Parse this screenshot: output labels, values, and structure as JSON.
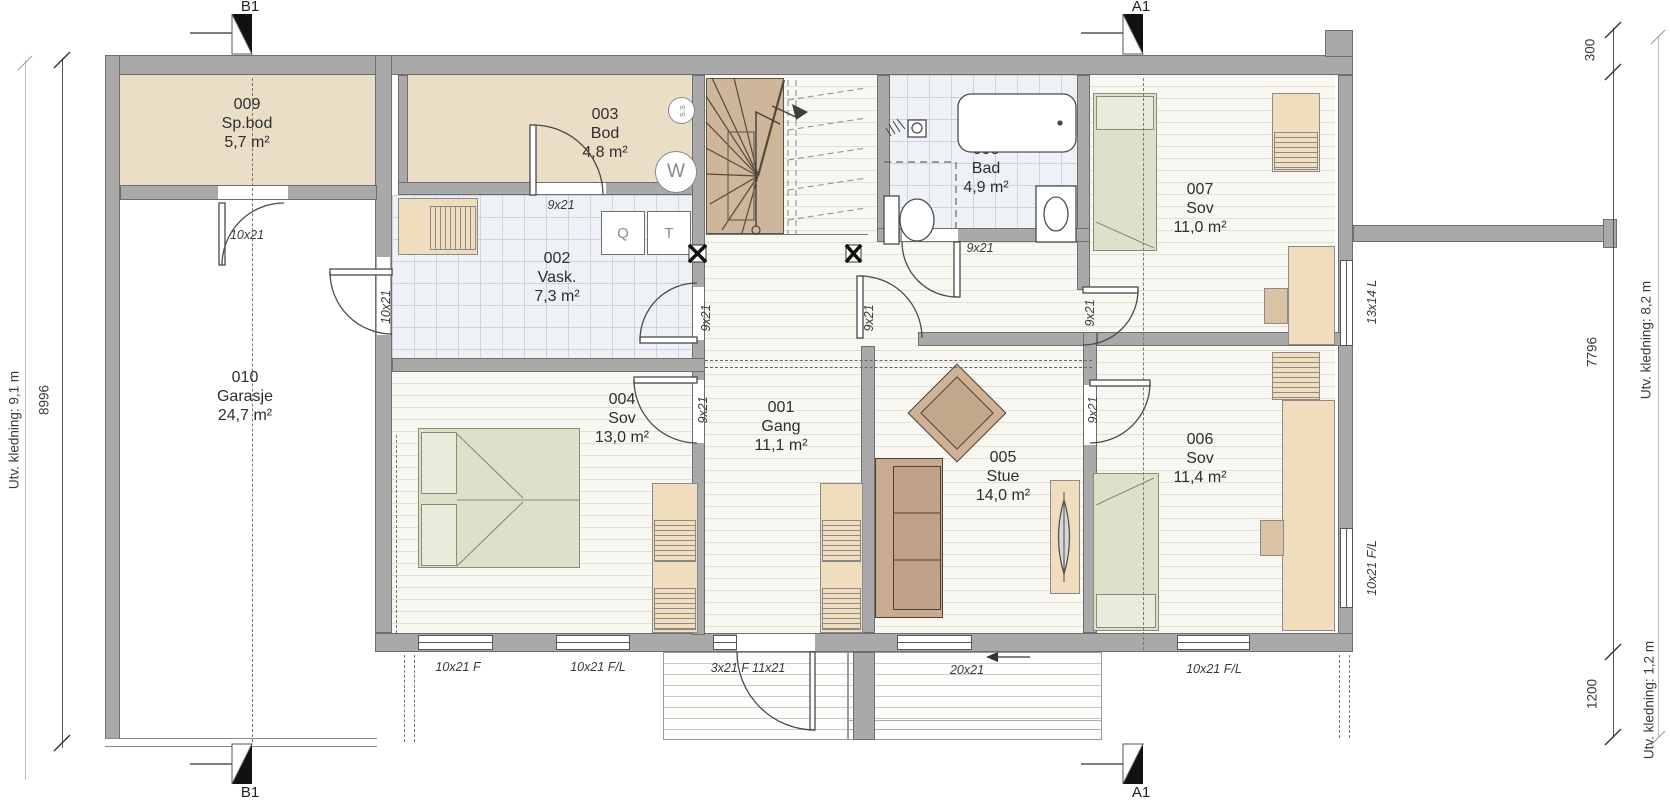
{
  "title": "Plan 1. etasje",
  "colors": {
    "wall": "#a9a9a9",
    "wall_border": "#6e6e6e",
    "storage_floor": "#ebdec7",
    "tile_floor": "#eef1f5",
    "wood_floor": "#f8f7f1",
    "stair": "#cdb699",
    "bed": "#dce1ca",
    "furniture": "#efddbd",
    "sofa": "#c9ac90",
    "text": "#2e2e2e"
  },
  "rooms": [
    {
      "id": "001",
      "name": "Gang",
      "area": "11,1 m²"
    },
    {
      "id": "002",
      "name": "Vask.",
      "area": "7,3 m²"
    },
    {
      "id": "003",
      "name": "Bod",
      "area": "4,8 m²"
    },
    {
      "id": "004",
      "name": "Sov",
      "area": "13,0 m²"
    },
    {
      "id": "005",
      "name": "Stue",
      "area": "14,0 m²"
    },
    {
      "id": "006",
      "name": "Sov",
      "area": "11,4 m²"
    },
    {
      "id": "007",
      "name": "Sov",
      "area": "11,0 m²"
    },
    {
      "id": "008",
      "name": "Bad",
      "area": "4,9 m²"
    },
    {
      "id": "009",
      "name": "Sp.bod",
      "area": "5,7 m²"
    },
    {
      "id": "010",
      "name": "Garasje",
      "area": "24,7 m²"
    }
  ],
  "openings": {
    "door_spbod": "10x21",
    "door_garage_vask": "10x21",
    "door_bod": "9x21",
    "door_bath": "9x21",
    "door_hall_vask": "9x21",
    "door_hall_stue": "9x21",
    "door_sov004": "9x21",
    "door_sov007": "9x21",
    "door_sov006": "9x21",
    "win_bottom_1": "10x21 F",
    "win_bottom_2": "10x21 F/L",
    "entry_door": "3x21 F 11x21",
    "win_terrace": "20x21",
    "win_bottom_3": "10x21 F/L",
    "win_007_side": "13x14 L",
    "win_006_side": "10x21 F/L"
  },
  "fixtures": {
    "central_vac": "s.s",
    "washer": "W",
    "sink": "Q",
    "dryer": "T"
  },
  "markers": {
    "a1": "A1",
    "b1": "B1"
  },
  "dimensions": {
    "left_mm": "8996",
    "left_cladding": "Utv. kledning: 9,1 m",
    "right_offset_mm": "300",
    "right_mm": "7796",
    "right_bottom_mm": "1200",
    "right_cladding": "Utv. kledning: 8,2 m",
    "right_cladding_bottom": "Utv. kledning: 1,2 m"
  }
}
